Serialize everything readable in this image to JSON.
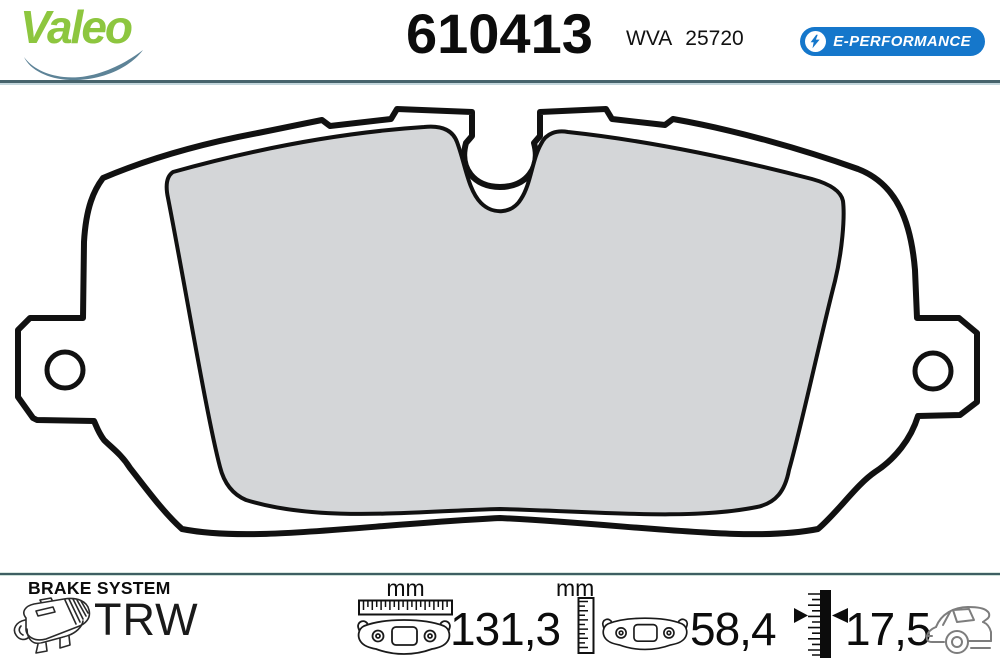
{
  "header": {
    "brand": "Valeo",
    "part_number": "610413",
    "wva_label": "WVA",
    "wva_number": "25720",
    "badge_label": "E-PERFORMANCE"
  },
  "drawing": {
    "subject": "rear brake pad technical drawing: backing plate with two mounting ears with holes, gray friction material, central wear-sensor notch",
    "friction_color": "#d4d6d8",
    "outline_color": "#111111"
  },
  "footer": {
    "brake_system_label": "BRAKE SYSTEM",
    "brake_system_brand": "TRW",
    "width": {
      "unit_label": "mm",
      "value": "131,3"
    },
    "height": {
      "unit_label": "mm",
      "value": "58,4"
    },
    "thickness": {
      "value": "17,5"
    },
    "axle_icon": "rear-axle-car"
  },
  "colors": {
    "valeo_green": "#8dc63f",
    "swoosh_blue": "#5d8397",
    "badge_blue": "#1577cb",
    "divider_dark": "#46636c",
    "divider_light": "#c3d6dc",
    "friction_gray": "#d4d6d8"
  }
}
